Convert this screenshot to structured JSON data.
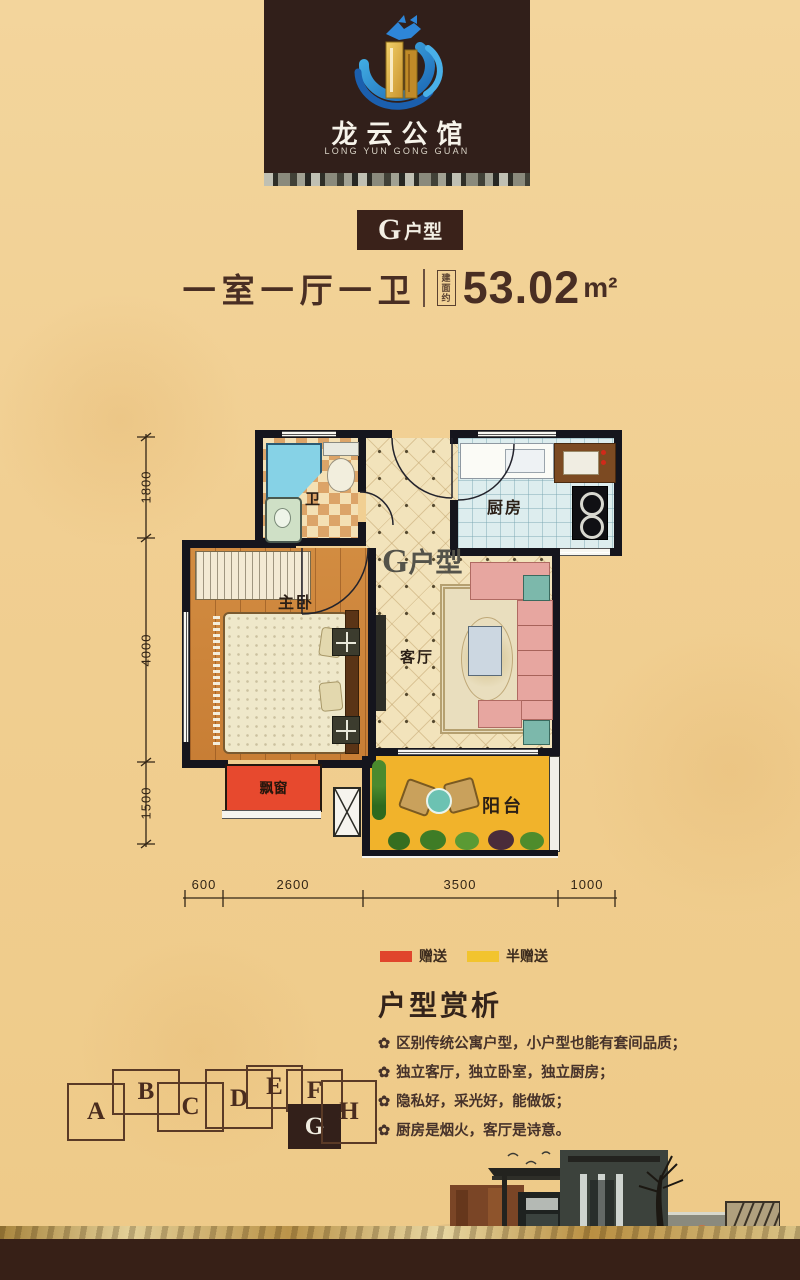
{
  "poster": {
    "background_color": "#f1cf92",
    "footer_band_color": "#372017"
  },
  "logo": {
    "name_cn": "龙云公馆",
    "name_en": "LONG YUN GONG GUAN"
  },
  "unit_badge": {
    "letter": "G",
    "suffix": "户型"
  },
  "summary": {
    "rooms_text": "一室一厅一卫",
    "area_prefix": "建面约",
    "area_value": "53.02",
    "area_unit": "m²"
  },
  "floorplan": {
    "unit_label": {
      "letter": "G",
      "suffix": "户型"
    },
    "rooms": {
      "bath": "卫",
      "kitchen": "厨房",
      "bedroom": "主卧",
      "living": "客厅",
      "bay_window": "飘窗",
      "balcony": "阳台"
    },
    "dims_vertical": [
      "1800",
      "4000",
      "1500"
    ],
    "dims_horizontal": [
      "600",
      "2600",
      "3500",
      "1000"
    ]
  },
  "legend": {
    "gift": {
      "label": "赠送",
      "color": "#e0452c"
    },
    "half_gift": {
      "label": "半赠送",
      "color": "#f2c42e"
    }
  },
  "analysis": {
    "heading": "户型赏析",
    "bullet": "✿",
    "points": [
      "区别传统公寓户型，小户型也能有套间品质；",
      "独立客厅，独立卧室，独立厨房；",
      "隐私好，采光好，能做饭；",
      "厨房是烟火，客厅是诗意。"
    ]
  },
  "building_key": {
    "units": [
      "A",
      "B",
      "C",
      "D",
      "E",
      "F",
      "G",
      "H"
    ],
    "highlighted_unit": "G"
  }
}
